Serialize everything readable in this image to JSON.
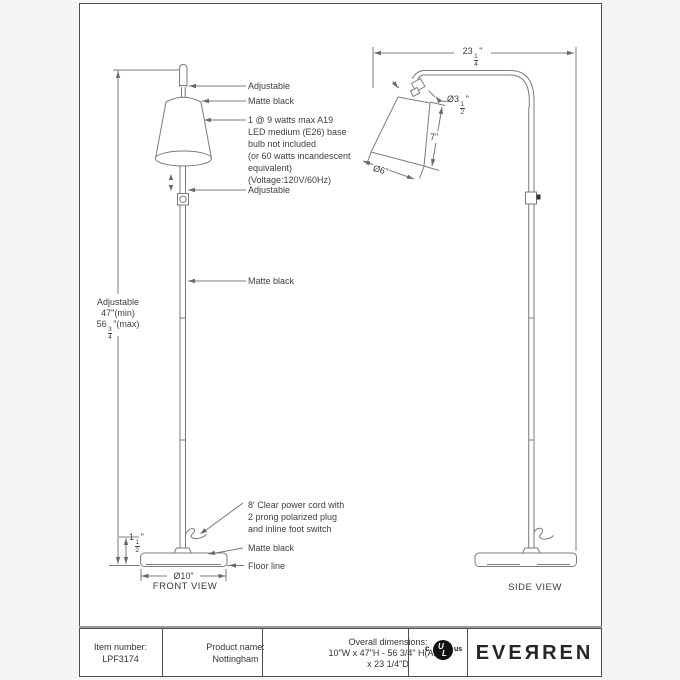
{
  "front": {
    "adjustable_top": "Adjustable",
    "shade_finish": "Matte black",
    "bulb": [
      "1 @ 9 watts max A19",
      "LED medium (E26) base",
      "bulb not included",
      "(or 60 watts incandescent",
      "equivalent)",
      "(Voltage:120V/60Hz)"
    ],
    "adjustable_mid": "Adjustable",
    "pole_finish": "Matte black",
    "cord": [
      "8' Clear power cord with",
      "2 prong polarized plug",
      "and inline foot switch"
    ],
    "base_finish": "Matte black",
    "floor_line": "Floor line",
    "height_label": "Adjustable",
    "height_min": "47\"(min)",
    "height_max": {
      "whole": "56",
      "num": "3",
      "den": "4",
      "suffix": "\"(max)"
    },
    "base_height": {
      "whole": "1",
      "num": "1",
      "den": "2",
      "suffix": "\""
    },
    "base_diameter": "Ø10\"",
    "view_label": "FRONT VIEW"
  },
  "side": {
    "depth": {
      "whole": "23",
      "num": "1",
      "den": "4",
      "suffix": "\""
    },
    "shade_top_diameter": {
      "whole": "Ø3",
      "num": "1",
      "den": "2",
      "suffix": "\""
    },
    "shade_height": "7\"",
    "shade_diameter": "Ø6\"",
    "view_label": "SIDE VIEW"
  },
  "title_block": {
    "item_label": "Item number:",
    "item_value": "LPF3174",
    "product_label": "Product name:",
    "product_value": "Nottingham",
    "dims_label": "Overall dimensions:",
    "dims_value_1": "10\"W x 47\"H - 56 3/4\" H(ADJ)",
    "dims_value_2": "x 23 1/4\"D",
    "certification": {
      "c": "c",
      "u": "U",
      "l": "L",
      "us": "us"
    },
    "brand": "EVEЯREN"
  },
  "colors": {
    "line": "#7b7b7b",
    "text": "#3f3f3f",
    "sheet_border": "#4f4f4f"
  }
}
